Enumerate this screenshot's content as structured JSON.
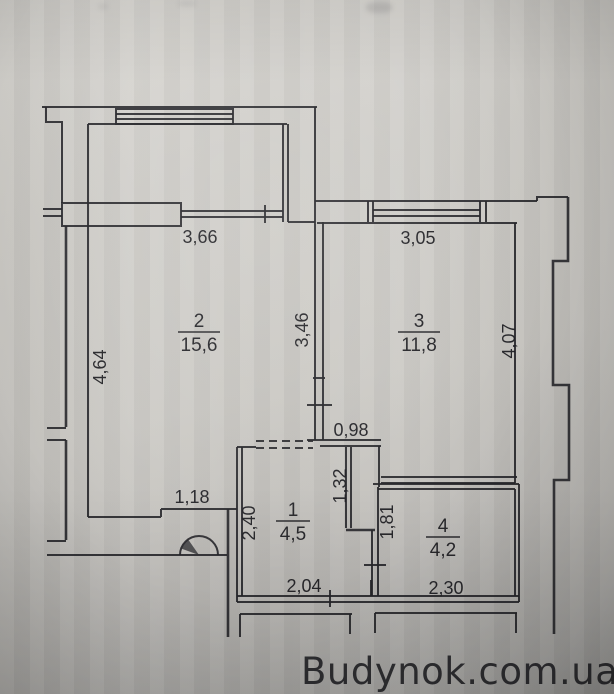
{
  "watermark": {
    "text": "Budynok.com.ua",
    "color": "#3143a8"
  },
  "plan": {
    "rooms": [
      {
        "number": "1",
        "area": "4,5"
      },
      {
        "number": "2",
        "area": "15,6"
      },
      {
        "number": "3",
        "area": "11,8"
      },
      {
        "number": "4",
        "area": "4,2"
      }
    ],
    "dimensions": {
      "room2_top": "3,66",
      "room3_top": "3,05",
      "room2_left": "4,64",
      "partition_mid": "3,46",
      "room3_right": "4,07",
      "room3_door": "0,98",
      "hall_right": "1,32",
      "room2_bottom": "1,18",
      "hall_left": "2,40",
      "room4_left": "1,81",
      "hall_bottom": "2,04",
      "room4_bottom": "2,30"
    }
  }
}
